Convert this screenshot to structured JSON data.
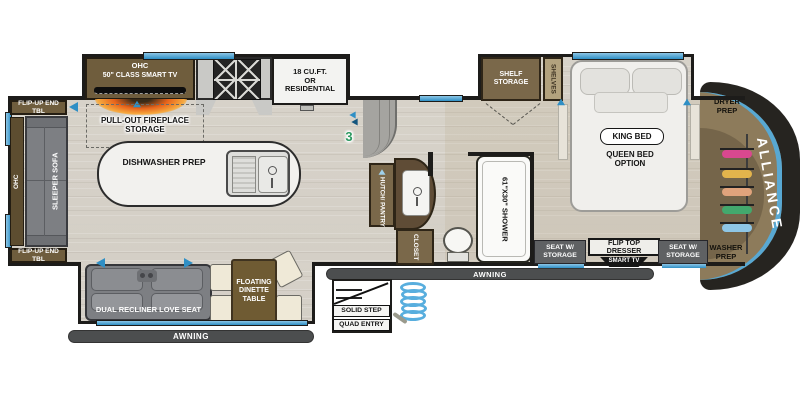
{
  "plan": {
    "brand": "ALLIANCE",
    "rear": {
      "flip_up_end_tbl_top": "FLIP-UP END TBL",
      "flip_up_end_tbl_bottom": "FLIP-UP END TBL",
      "ohc": "OHC",
      "sleeper_sofa": "SLEEPER SOFA"
    },
    "kitchen": {
      "ohc": "OHC",
      "smart_tv": "50\" CLASS SMART TV",
      "fireplace": "PULL-OUT FIREPLACE STORAGE",
      "fridge_line1": "18 CU.FT.",
      "fridge_line2": "OR",
      "fridge_line3": "RESIDENTIAL",
      "island": "DISHWASHER PREP"
    },
    "living": {
      "loveseat": "DUAL RECLINER LOVE SEAT",
      "dinette": "FLOATING DINETTE TABLE",
      "awning": "AWNING"
    },
    "entry": {
      "solid_step": "SOLID STEP",
      "quad_entry": "QUAD ENTRY",
      "step_count": "3",
      "awning": "AWNING"
    },
    "bath": {
      "hutch_pantry": "HUTCH/ PANTRY",
      "closet": "CLOSET",
      "shower": "61\"x30\" SHOWER"
    },
    "bedroom": {
      "shelf_storage": "SHELF STORAGE",
      "shelves": "SHELVES",
      "king_bed": "KING BED",
      "queen_bed_option": "QUEEN BED OPTION",
      "seat_w_storage_left": "SEAT W/ STORAGE",
      "seat_w_storage_right": "SEAT W/ STORAGE",
      "flip_top_dresser": "FLIP TOP DRESSER",
      "smart_tv": "SMART TV"
    },
    "front_cap": {
      "dryer_prep": "DRYER PREP",
      "washer_prep": "WASHER PREP"
    },
    "colors": {
      "accent_blue": "#45a1d2",
      "cabinet_brown": "#6f5d3d",
      "cap_tan": "#8d7b5b",
      "awning_gray": "#4c4e4f",
      "wall_black": "#1d1c1a",
      "floor": "#d7d2c9",
      "hanger_colors": [
        "#d9488f",
        "#e3b44c",
        "#e0a37c",
        "#43a86d",
        "#8ec6e6"
      ]
    }
  }
}
